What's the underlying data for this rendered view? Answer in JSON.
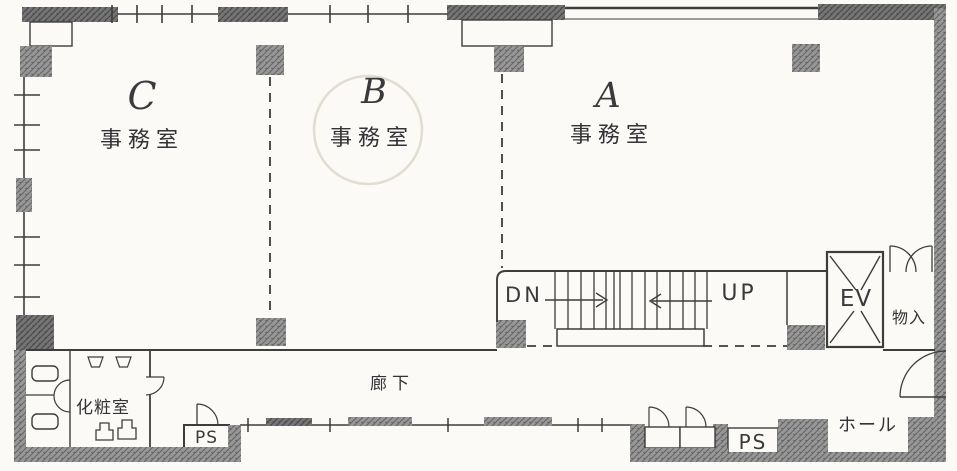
{
  "plan": {
    "type": "architectural-floor-plan",
    "offices": [
      {
        "id": "C",
        "letter": "C",
        "name": "事務室"
      },
      {
        "id": "B",
        "letter": "B",
        "name": "事務室"
      },
      {
        "id": "A",
        "letter": "A",
        "name": "事務室"
      }
    ],
    "stairs": {
      "down_label": "DN",
      "up_label": "UP"
    },
    "elevator_label": "EV",
    "storage_label": "物入",
    "restroom_label": "化粧室",
    "corridor_label": "廊下",
    "hall_label": "ホール",
    "pipe_space_left_label": "PS",
    "pipe_space_right_label": "PS"
  },
  "colors": {
    "ink": "#3d3d3d",
    "wall_hatch": "#8f8f8f",
    "wall_dark": "#6e6e6e",
    "paper": "#fbfaf7",
    "stamp": "#d9d2c4"
  }
}
